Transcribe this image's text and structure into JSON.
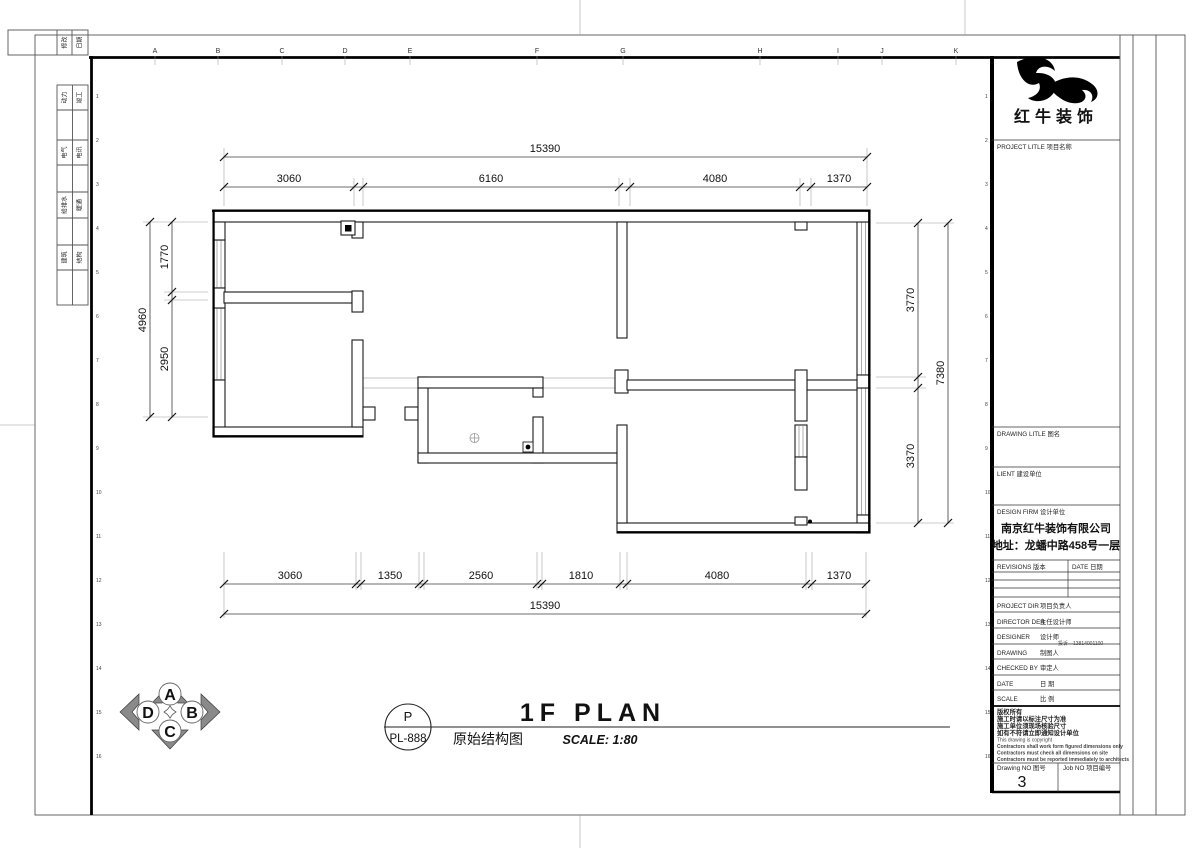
{
  "sheet": {
    "grid_letters": [
      "A",
      "B",
      "C",
      "D",
      "E",
      "F",
      "G",
      "H",
      "I",
      "J",
      "K"
    ],
    "grid_numbers": [
      "1",
      "2",
      "3",
      "4",
      "5",
      "6",
      "7",
      "8",
      "9",
      "10",
      "11",
      "12",
      "13",
      "14",
      "15",
      "16"
    ],
    "signoff_top": [
      "修改",
      "日期"
    ],
    "signoff_pairs": [
      [
        "动力",
        "竣工"
      ],
      [
        "电气",
        "电讯"
      ],
      [
        "给排水",
        "暖通"
      ],
      [
        "建筑",
        "结构"
      ]
    ]
  },
  "plan": {
    "dims": {
      "top_total": "15390",
      "top_segments": [
        "3060",
        "6160",
        "4080",
        "1370"
      ],
      "bottom_segments": [
        "3060",
        "1350",
        "2560",
        "1810",
        "4080",
        "1370"
      ],
      "bottom_total": "15390",
      "left_total": "4960",
      "left_segments": [
        "1770",
        "2950"
      ],
      "right_segments": [
        "3770",
        "3370"
      ],
      "right_total": "7380"
    }
  },
  "titleblock": {
    "company": "红牛装饰",
    "project_title_label": "PROJECT LITLE  项目名称",
    "drawing_title_label": "DRAWING LITLE  图名",
    "client_label": "LIENT  建设单位",
    "design_firm_label": "DESIGN FIRM  设计单位",
    "firm_name": "南京红牛装饰有限公司",
    "firm_address": "地址：龙蟠中路458号一层",
    "revisions_label": "REVISIONS  版本",
    "revisions_date_label": "DATE  日期",
    "staff": [
      {
        "en": "PROJECT DIR",
        "cn": "项目负责人",
        "extra": ""
      },
      {
        "en": "DIRECTOR DER",
        "cn": "主任设计师",
        "extra": ""
      },
      {
        "en": "DESIGNER",
        "cn": "设计师",
        "extra": "投诉—13814001100"
      },
      {
        "en": "DRAWING",
        "cn": "制图人",
        "extra": ""
      },
      {
        "en": "CHECKED BY",
        "cn": "审定人",
        "extra": ""
      },
      {
        "en": "DATE",
        "cn": "日  期",
        "extra": ""
      },
      {
        "en": "SCALE",
        "cn": "比  例",
        "extra": ""
      }
    ],
    "copyright": [
      "版权所有",
      "施工时请以标注尺寸为准",
      "施工单位须现场核验尺寸",
      "如有不符请立即通知设计单位",
      "This drawing is copyright",
      "Contractors shall work form figured dimensions only",
      "Contractors must check all dimensions on site",
      "Contractors must be reported immediately to architects"
    ],
    "drawing_no_label": "Drawing NO  图号",
    "drawing_no": "3",
    "job_no_label": "Job NO  项目编号"
  },
  "footer": {
    "compass_letters": [
      "A",
      "B",
      "C",
      "D"
    ],
    "ref_top": "P",
    "ref_code": "PL-888",
    "title_en": "1F PLAN",
    "title_cn": "原始结构图",
    "scale": "SCALE: 1:80"
  }
}
